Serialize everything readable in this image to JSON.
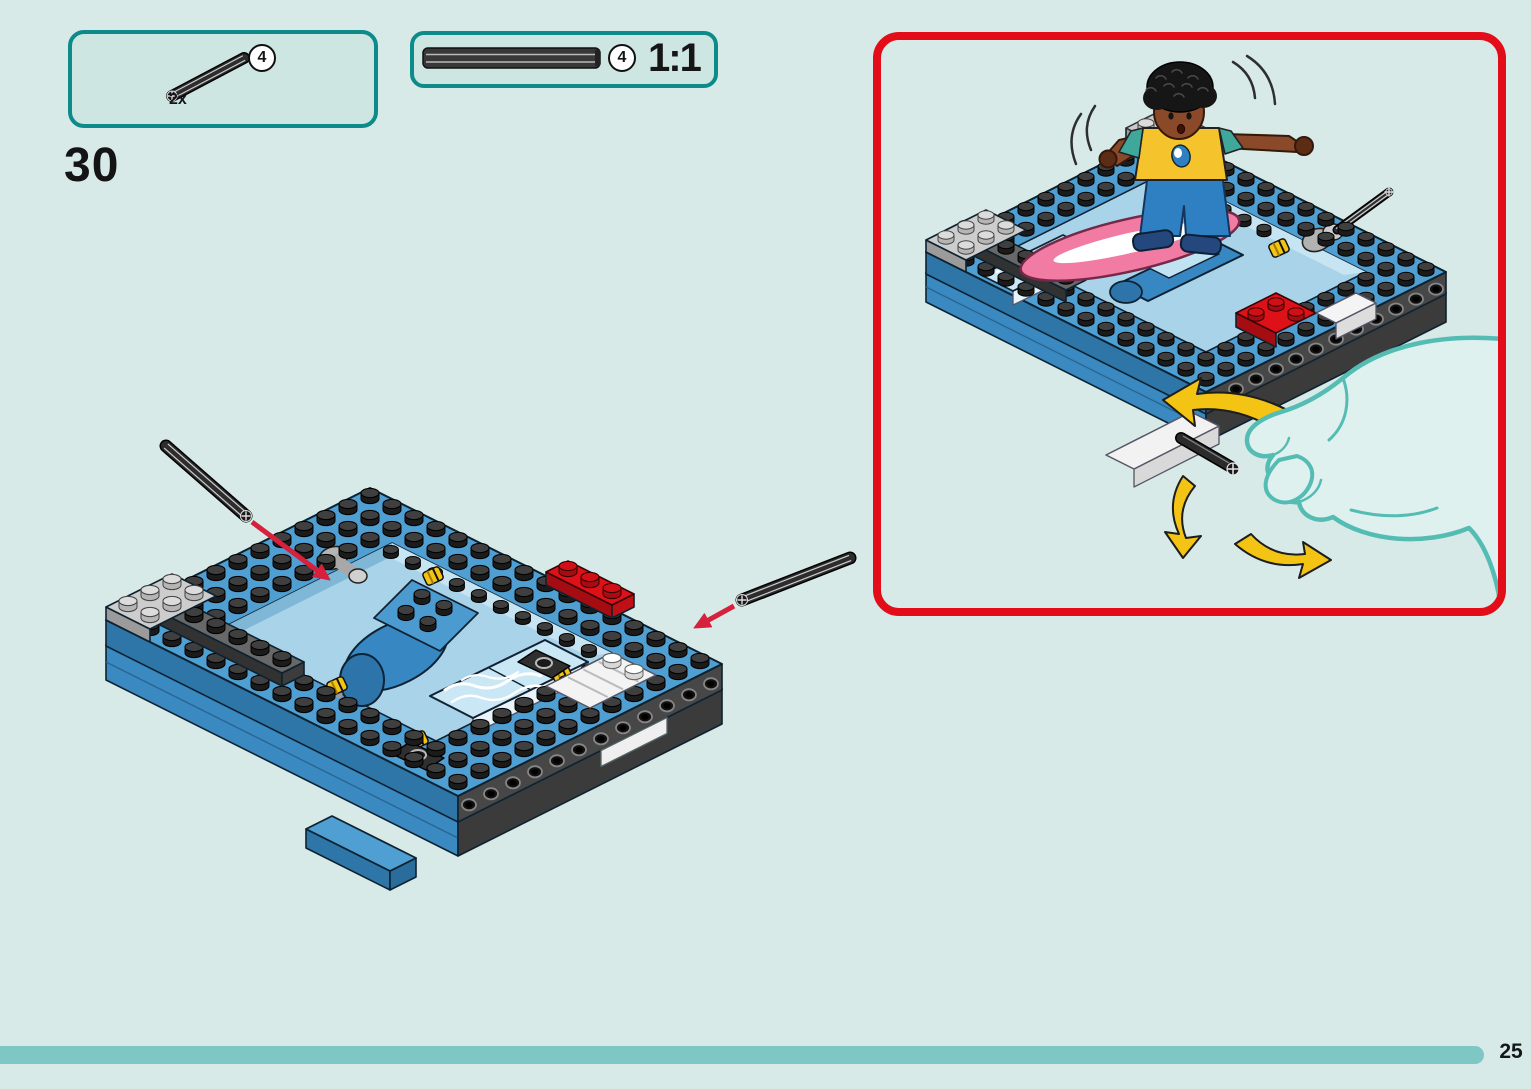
{
  "page": {
    "step_number": "30",
    "page_number": "25"
  },
  "palette": {
    "background": "#d7eae8",
    "callout_fill": "#cde6e2",
    "teal_border": "#0d8a8a",
    "red_border": "#e20d18",
    "progress_bar": "#7fc7c5",
    "insert_arrow_red": "#d6203c",
    "lego_blue": "#4f9fd2",
    "lego_blue_side": "#2f76a8",
    "lego_dark_gray": "#474747",
    "lego_red": "#de1119",
    "lego_yellow": "#f4c414",
    "surfboard_pink": "#f17ba3",
    "hand_outline": "#55bcb4",
    "hand_fill": "#def1ee"
  },
  "parts_box": {
    "quantity": "2x",
    "size_badge": "4",
    "part_icon": "technic-axle-4-icon"
  },
  "scale_box": {
    "size_badge": "4",
    "scale_label": "1:1",
    "part_icon": "technic-axle-actual-size-icon"
  },
  "main_illustration": {
    "icon": "build-step-model-illustration"
  },
  "result_box": {
    "icons": [
      "assembled-model-illustration",
      "minifigure-surfer-icon",
      "surfboard-icon",
      "hand-turning-crank-icon",
      "rotation-arrows-icon",
      "motion-arcs-icon",
      "insert-axle-icon"
    ]
  }
}
